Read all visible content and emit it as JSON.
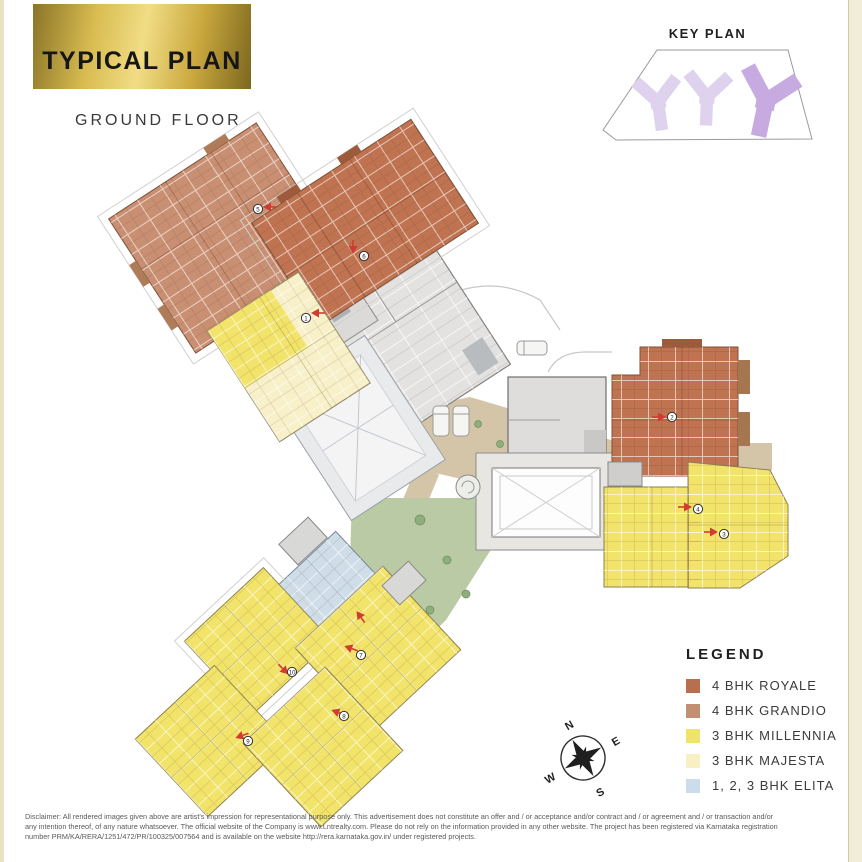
{
  "header": {
    "title": "TYPICAL PLAN",
    "subtitle": "GROUND FLOOR"
  },
  "key_plan": {
    "title": "KEY PLAN"
  },
  "legend": {
    "title": "LEGEND",
    "items": [
      {
        "label": "4 BHK ROYALE",
        "color": "#b76f4f"
      },
      {
        "label": "4 BHK GRANDIO",
        "color": "#c28f72"
      },
      {
        "label": "3 BHK MILLENNIA",
        "color": "#f0e369"
      },
      {
        "label": "3 BHK MAJESTA",
        "color": "#f8efc5"
      },
      {
        "label": "1, 2, 3 BHK ELITA",
        "color": "#cddced"
      }
    ]
  },
  "compass": {
    "n": "N",
    "e": "E",
    "s": "S",
    "w": "W"
  },
  "plan": {
    "markers": [
      "5",
      "6",
      "1",
      "2",
      "4",
      "3",
      "7",
      "10",
      "8",
      "9"
    ]
  },
  "disclaimer": {
    "line1": "Disclaimer: All rendered images given above are artist's impression for representational purpose only. This advertisement does not constitute an offer and / or acceptance and/or contract and / or agreement and / or transaction and/or",
    "line2": "any intention thereof, of any nature whatsoever. The official website of the Company is www.Lntrealty.com. Please do not rely on the information provided in any other website. The project has been registered via Karnataka registration",
    "line3": "number PRM/KA/RERA/1251/472/PR/100325/007564 and is available on the website http://rera.karnataka.gov.in/ under registered projects."
  }
}
